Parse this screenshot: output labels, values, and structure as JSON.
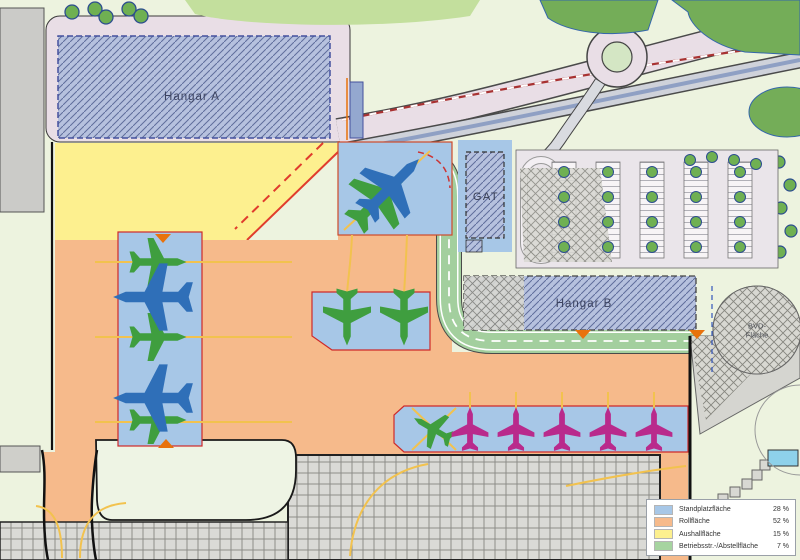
{
  "map_labels": {
    "hangar_a": "Hangar A",
    "gat": "GAT",
    "hangar_b": "Hangar B",
    "bvd_area": "BVD-Fläche"
  },
  "legend": {
    "items": [
      {
        "label": "Standplatzfläche",
        "value": "28 %",
        "color": "#a7c7e7"
      },
      {
        "label": "Rollfläche",
        "value": "52 %",
        "color": "#f6ba8b"
      },
      {
        "label": "Aushallfläche",
        "value": "15 %",
        "color": "#fdf08f"
      },
      {
        "label": "Betriebsstr.-/Abstellfläche",
        "value": "7 %",
        "color": "#a6d4a0"
      }
    ]
  },
  "colors": {
    "background": "#edf3df",
    "stand_area": "#a7c7e7",
    "taxi_area": "#f6ba8b",
    "expansion_area": "#fdf08f",
    "ops_road_area": "#a3cf9e",
    "hangar_fill": "#b6c1de",
    "forest": "#74ad58",
    "road_pink": "#e9dee6",
    "guideline_yellow": "#f2c24e",
    "boundary_red": "#e03c2d",
    "aircraft_green": "#3f9e3f",
    "aircraft_blue": "#2f6fb8",
    "aircraft_magenta": "#b92a8c"
  }
}
